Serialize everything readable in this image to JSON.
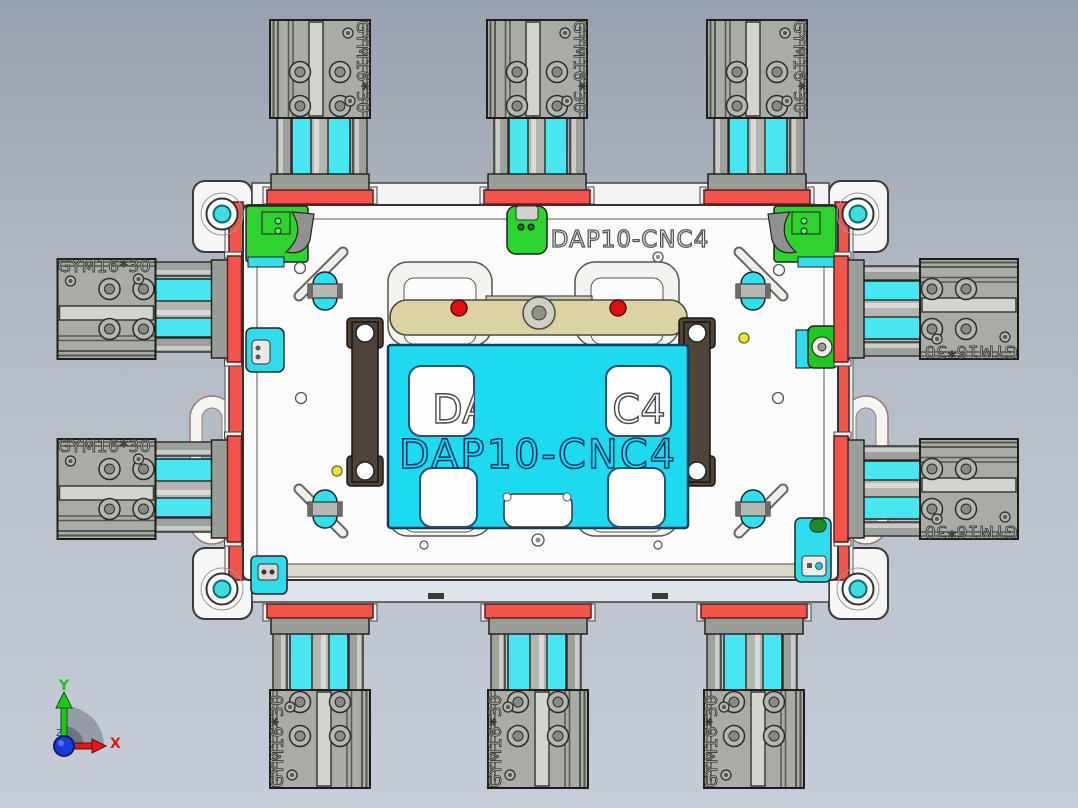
{
  "viewport": {
    "kind": "cad-3d-viewport",
    "width": 1078,
    "height": 808
  },
  "part_labels": {
    "top_engraving": "DAP10-CNC4",
    "center_engraving": "DAP10-CNC4",
    "pocket_left": "DA",
    "pocket_right": "C4"
  },
  "cylinder": {
    "label": "GYM16*30",
    "count": 10
  },
  "axis_triad": {
    "x": "X",
    "y": "Y",
    "z": "Z"
  },
  "colors": {
    "background_top": "#98a1af",
    "background_bottom": "#c6ccd8",
    "cyan": "#1edaf0",
    "cyan_band": "#49e6f1",
    "green": "#2fd32f",
    "red": "#f2544b",
    "beige": "#dcd2a4",
    "dark_clamp": "#4e4438",
    "cylinder_gray": "#a9aca4",
    "plate_white": "#fbfbfb",
    "axis_x": "#e01818",
    "axis_y": "#1ec61e",
    "origin_blue": "#1d39d8"
  }
}
